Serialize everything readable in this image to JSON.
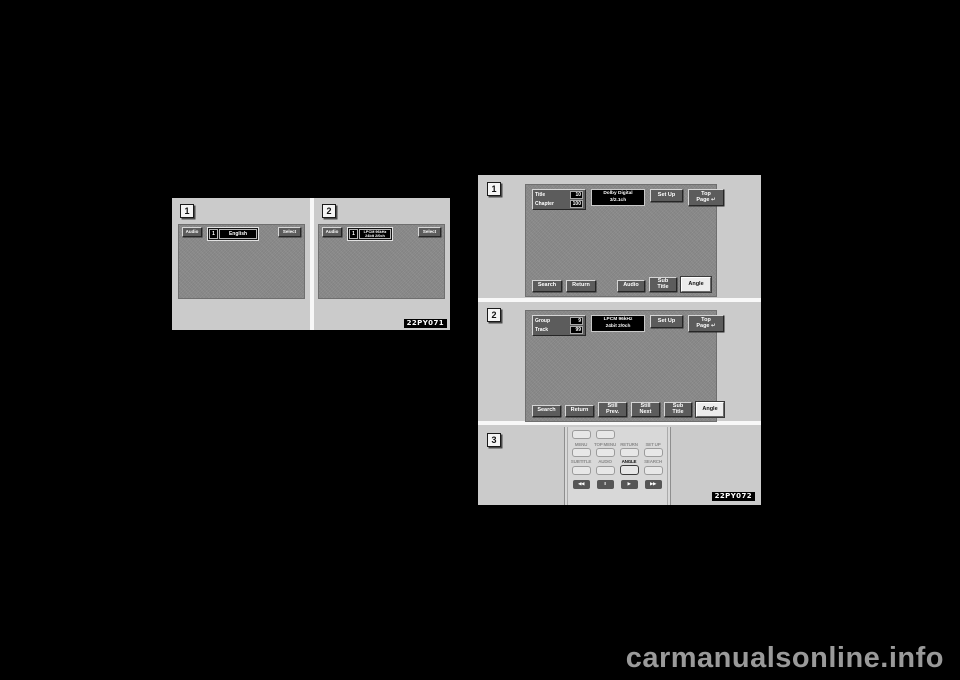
{
  "watermark": "carmanualsonline.info",
  "figure1": {
    "caption": "22PY071",
    "panel1": {
      "number": "1",
      "audio": "Audio",
      "num": "1",
      "language": "English",
      "select": "Select"
    },
    "panel2": {
      "number": "2",
      "audio": "Audio",
      "num": "1",
      "format1": "LPCM 96kHz",
      "format2": "24bit 2/0ch",
      "select": "Select"
    }
  },
  "figure2": {
    "caption": "22PY072",
    "panel1": {
      "number": "1",
      "title_label": "Title",
      "title_value": "10",
      "chapter_label": "Chapter",
      "chapter_value": "100",
      "format1": "Dolby Digital",
      "format2": "3/2.1ch",
      "setup": "Set Up",
      "top1": "Top",
      "top2": "Page ↵",
      "search": "Search",
      "return": "Return",
      "audio": "Audio",
      "sub1": "Sub",
      "sub2": "Title",
      "angle": "Angle"
    },
    "panel2": {
      "number": "2",
      "group_label": "Group",
      "group_value": "9",
      "track_label": "Track",
      "track_value": "99",
      "format1": "LPCM 96kHz",
      "format2": "24bit 2/0ch",
      "setup": "Set Up",
      "top1": "Top",
      "top2": "Page ↵",
      "search": "Search",
      "return": "Return",
      "prev1": "Still",
      "prev2": "Prev.",
      "next1": "Still",
      "next2": "Next",
      "sub1": "Sub",
      "sub2": "Title",
      "angle": "Angle"
    },
    "panel3": {
      "number": "3",
      "labels_row1": [
        "MENU",
        "TOP MENU",
        "RETURN",
        "SET UP"
      ],
      "labels_row2": [
        "SUBTITLE",
        "AUDIO",
        "ANGLE",
        "SEARCH"
      ],
      "playback": [
        "◀◀",
        "II",
        "▶",
        "▶▶"
      ]
    }
  },
  "colors": {
    "page_bg": "#000000",
    "figure_bg": "#cbcbcb",
    "screen_bg": "#8b8b8b",
    "button_dark": "#5c5c5c",
    "button_highlight": "#ececec",
    "caption_bg": "#000000",
    "watermark_gray": "#9a9a9a"
  }
}
